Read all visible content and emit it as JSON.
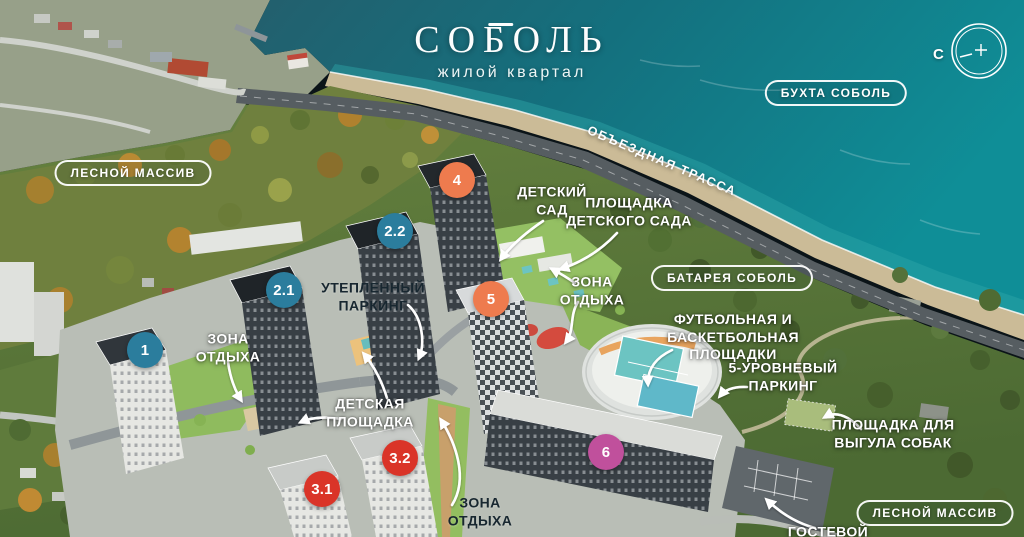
{
  "project": {
    "title": "СОБОЛЬ",
    "subtitle": "жилой квартал"
  },
  "compass": {
    "north": "С"
  },
  "road_label": "ОБЪЕЗДНАЯ ТРАССА",
  "area_badges": {
    "bay": "БУХТА СОБОЛЬ",
    "forest_left": "ЛЕСНОЙ МАССИВ",
    "battery": "БАТАРЕЯ СОБОЛЬ",
    "forest_bottom": "ЛЕСНОЙ МАССИВ"
  },
  "building_markers": [
    {
      "num": "1",
      "color": "#2b7d9d"
    },
    {
      "num": "2.1",
      "color": "#2b7d9d"
    },
    {
      "num": "2.2",
      "color": "#2b7d9d"
    },
    {
      "num": "4",
      "color": "#ee7b4e"
    },
    {
      "num": "5",
      "color": "#ee7b4e"
    },
    {
      "num": "3.1",
      "color": "#da3428"
    },
    {
      "num": "3.2",
      "color": "#da3428"
    },
    {
      "num": "6",
      "color": "#c0509c"
    }
  ],
  "poi_labels": {
    "kindergarten": {
      "l1": "ДЕТСКИЙ",
      "l2": "САД"
    },
    "kindergarten_playground": {
      "l1": "ПЛОЩАДКА",
      "l2": "ДЕТСКОГО САДА"
    },
    "rest_zone_center": {
      "l1": "ЗОНА",
      "l2": "ОТДЫХА"
    },
    "warm_parking": {
      "l1": "УТЕПЛЕННЫЙ",
      "l2": "ПАРКИНГ"
    },
    "rest_zone_left": {
      "l1": "ЗОНА",
      "l2": "ОТДЫХА"
    },
    "kids_playground": {
      "l1": "ДЕТСКАЯ",
      "l2": "ПЛОЩАДКА"
    },
    "sports_grounds": {
      "l1": "ФУТБОЛЬНАЯ И",
      "l2": "БАСКЕТБОЛЬНАЯ",
      "l3": "ПЛОЩАДКИ"
    },
    "multilevel_parking": {
      "l1": "5-УРОВНЕВЫЙ",
      "l2": "ПАРКИНГ"
    },
    "dog_walking_area": {
      "l1": "ПЛОЩАДКА ДЛЯ",
      "l2": "ВЫГУЛА СОБАК"
    },
    "rest_zone_bottom": {
      "l1": "ЗОНА",
      "l2": "ОТДЫХА"
    },
    "guest_parking": {
      "l1": "ГОСТЕВОЙ"
    }
  },
  "colors": {
    "marker_blue": "#2b7d9d",
    "marker_orange": "#ee7b4e",
    "marker_red": "#da3428",
    "marker_pink": "#c0509c",
    "label_light": "#ffffff",
    "label_dark": "#182730",
    "sea": "#14808d"
  }
}
